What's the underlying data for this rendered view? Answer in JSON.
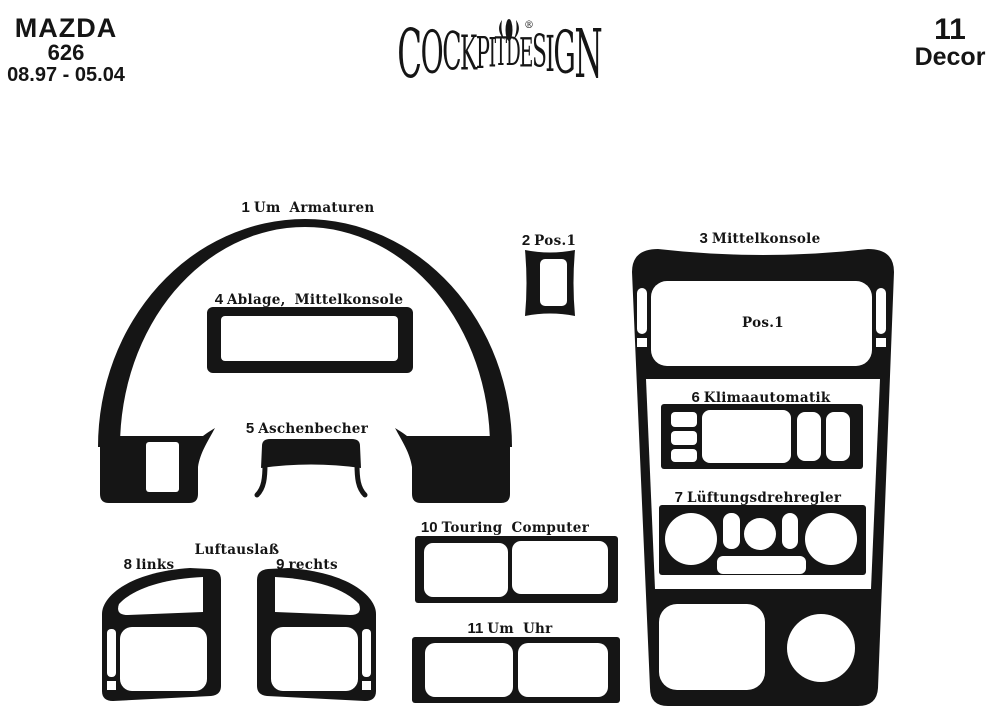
{
  "colors": {
    "ink": "#151515",
    "background": "#ffffff"
  },
  "header": {
    "vehicle": {
      "make": "MAZDA",
      "model": "626",
      "years": "08.97 - 05.04"
    },
    "brand": {
      "name": "COCKPITDESIGN",
      "letters": [
        "C",
        "O",
        "C",
        "K",
        "P",
        "I",
        "T",
        "D",
        "E",
        "S",
        "I",
        "G",
        "N"
      ],
      "registered_mark": "®"
    },
    "kit": {
      "piece_count": "11",
      "label": "Decor"
    }
  },
  "parts": {
    "p1": {
      "num": "1",
      "label": "Um Armaturen"
    },
    "p2": {
      "num": "2",
      "label": "Pos.1"
    },
    "p3": {
      "num": "3",
      "label": "Mittelkonsole"
    },
    "p4": {
      "num": "4",
      "label": "Ablage, Mittelkonsole"
    },
    "p5": {
      "num": "5",
      "label": "Aschenbecher"
    },
    "p6": {
      "num": "6",
      "label": "Klimaautomatik"
    },
    "p7": {
      "num": "7",
      "label": "Lüftungsdrehregler"
    },
    "p8": {
      "num": "8",
      "label": "links"
    },
    "p9": {
      "num": "9",
      "label": "rechts"
    },
    "p10": {
      "num": "10",
      "label": "Touring Computer"
    },
    "p11": {
      "num": "11",
      "label": "Um Uhr"
    },
    "vents_caption": "Luftauslaß",
    "console_pos_label": "Pos.1"
  }
}
